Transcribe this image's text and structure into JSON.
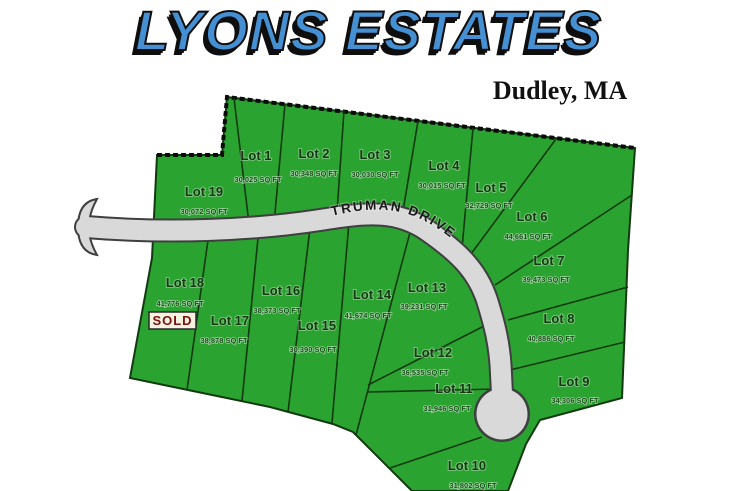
{
  "title": {
    "text": "LYONS ESTATES"
  },
  "subtitle": {
    "text": "Dudley, MA"
  },
  "road": {
    "name": "TRUMAN DRIVE"
  },
  "sold_badge": "SOLD",
  "colors": {
    "lot_green": "#2ba330",
    "boundary": "#123a10",
    "road_gray": "#d9d9d9",
    "road_outline": "#3f3f3f",
    "title_blue": "#4590d2",
    "sold_red": "#7a1010"
  },
  "lots": [
    {
      "id": 1,
      "label": "Lot 1",
      "area": "30,025 SQ FT"
    },
    {
      "id": 2,
      "label": "Lot 2",
      "area": "30,348 SQ FT"
    },
    {
      "id": 3,
      "label": "Lot 3",
      "area": "30,030 SQ FT"
    },
    {
      "id": 4,
      "label": "Lot 4",
      "area": "30,015 SQ FT"
    },
    {
      "id": 5,
      "label": "Lot 5",
      "area": "32,729 SQ FT"
    },
    {
      "id": 6,
      "label": "Lot 6",
      "area": "44,661 SQ FT"
    },
    {
      "id": 7,
      "label": "Lot 7",
      "area": "39,473 SQ FT"
    },
    {
      "id": 8,
      "label": "Lot 8",
      "area": "40,886 SQ FT"
    },
    {
      "id": 9,
      "label": "Lot 9",
      "area": "34,306 SQ FT"
    },
    {
      "id": 10,
      "label": "Lot 10",
      "area": "31,802 SQ FT"
    },
    {
      "id": 11,
      "label": "Lot 11",
      "area": "31,946 SQ FT"
    },
    {
      "id": 12,
      "label": "Lot 12",
      "area": "36,535 SQ FT"
    },
    {
      "id": 13,
      "label": "Lot 13",
      "area": "39,231 SQ FT"
    },
    {
      "id": 14,
      "label": "Lot 14",
      "area": "41,674 SQ FT"
    },
    {
      "id": 15,
      "label": "Lot 15",
      "area": "30,390 SQ FT"
    },
    {
      "id": 16,
      "label": "Lot 16",
      "area": "38,373 SQ FT"
    },
    {
      "id": 17,
      "label": "Lot 17",
      "area": "38,878 SQ FT"
    },
    {
      "id": 18,
      "label": "Lot 18",
      "area": "41,776 SQ FT",
      "sold": true
    },
    {
      "id": 19,
      "label": "Lot 19",
      "area": "30,072 SQ FT"
    }
  ]
}
